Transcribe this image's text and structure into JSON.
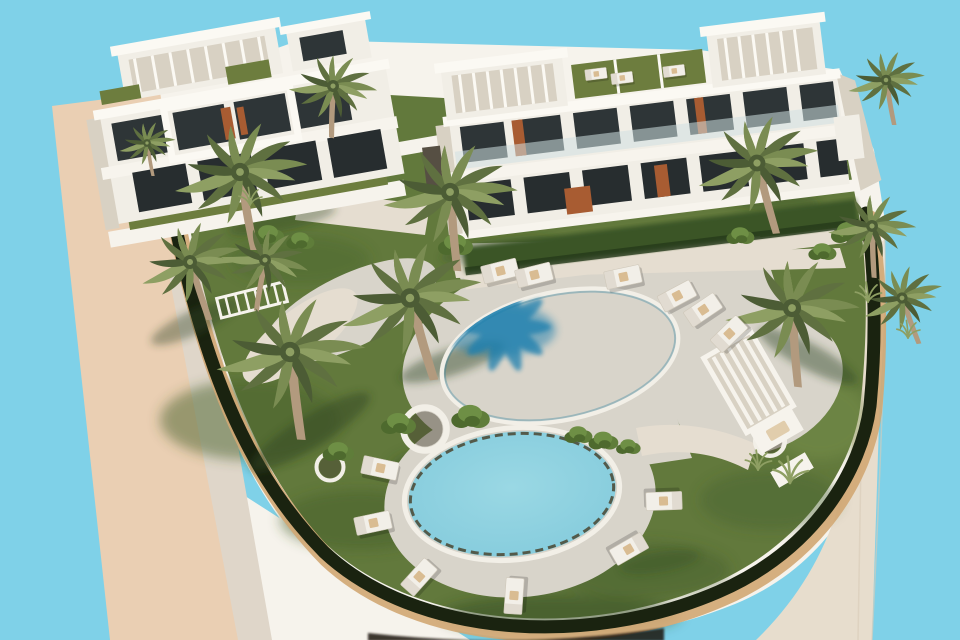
{
  "scene": {
    "type": "3d-architectural-rendering",
    "description": "Aerial 3D rendering of a modern white resort apartment complex: two flat-roofed buildings with pergolas, a large oval swimming pool and a round pool ringed by sun loungers, palm trees, lawns and a curved white boundary wall against a plain light-blue sky background.",
    "palette": {
      "sky": "#7FD1E8",
      "sand": "#EACFB3",
      "sandInner": "#DFD6C9",
      "pavement": "#E7DDCD",
      "seam": "#D9CCB7",
      "wallWhite": "#F6F3EC",
      "hedgeDark": "#1A2310",
      "hedgeTrim": "#D2A773",
      "grass": "#62793C",
      "grassDark": "#46602C",
      "grassLight": "#7D9751",
      "deck": "#D8D4CA",
      "walkwayLight": "#E5DDD0",
      "poolDeep": "#2F98C0",
      "poolMid": "#5FBAD4",
      "poolLight": "#8FD3E1",
      "poolShadow": "#1D7FAE",
      "poolRim": "#2A7D9E",
      "roundPoolLight": "#9AD8E4",
      "roundPoolMid": "#84CBDC",
      "rimDark": "#4A4530",
      "coping": "#F2EFE7",
      "building": "#F1EEE6",
      "buildingShade": "#D8D1C3",
      "slab": "#F7F4ED",
      "slabTop": "#FBF9F3",
      "window": "#2E3537",
      "windowDark": "#272D2F",
      "glassRail": "#CFE0E2",
      "roofTurf": "#6D7D3E",
      "frontHedge": "#3B5526",
      "terracotta": "#A85C32",
      "trunk": "#B29A7E",
      "frond1": "#5F7040",
      "frond2": "#7A8C52",
      "frond3": "#8E9F63",
      "frond4": "#4C5C35",
      "loungerBody": "#F2EFE8",
      "loungerEdge": "#CFC8BA",
      "towel": "#D9BC92",
      "bush1": "#4E6A2E",
      "bush2": "#5F7D3A",
      "bush3": "#6E8F45",
      "shadowGreen": "#2F4520",
      "bottomShadow": "#1F160C"
    },
    "distant_palms": [
      {
        "x": 368,
        "y": 100,
        "s": 0.4,
        "r": 0
      },
      {
        "x": 392,
        "y": 95,
        "s": 0.45,
        "r": 8
      },
      {
        "x": 424,
        "y": 90,
        "s": 0.4,
        "r": -6
      }
    ],
    "palms": [
      {
        "x": 240,
        "y": 172,
        "s": 1.3,
        "r": 0
      },
      {
        "x": 333,
        "y": 86,
        "s": 0.85,
        "r": 12
      },
      {
        "x": 190,
        "y": 262,
        "s": 1.0,
        "r": -8
      },
      {
        "x": 265,
        "y": 260,
        "s": 0.85,
        "r": 20
      },
      {
        "x": 450,
        "y": 192,
        "s": 1.3,
        "r": 5
      },
      {
        "x": 757,
        "y": 163,
        "s": 1.2,
        "r": -5
      },
      {
        "x": 872,
        "y": 226,
        "s": 0.85,
        "r": 8
      },
      {
        "x": 902,
        "y": 298,
        "s": 0.8,
        "r": -10
      },
      {
        "x": 290,
        "y": 352,
        "s": 1.45,
        "r": 3
      },
      {
        "x": 410,
        "y": 298,
        "s": 1.4,
        "r": -6
      },
      {
        "x": 792,
        "y": 308,
        "s": 1.3,
        "r": 6
      },
      {
        "x": 886,
        "y": 80,
        "s": 0.75,
        "r": 0
      },
      {
        "x": 147,
        "y": 143,
        "s": 0.55,
        "r": 0
      }
    ],
    "loungers": [
      {
        "x": 500,
        "y": 271,
        "r": -14,
        "s": 1
      },
      {
        "x": 534,
        "y": 275,
        "r": -14,
        "s": 1
      },
      {
        "x": 623,
        "y": 277,
        "r": -12,
        "s": 1
      },
      {
        "x": 677,
        "y": 296,
        "r": -28,
        "s": 1
      },
      {
        "x": 703,
        "y": 310,
        "r": -34,
        "s": 1
      },
      {
        "x": 729,
        "y": 334,
        "r": -44,
        "s": 1
      },
      {
        "x": 380,
        "y": 468,
        "r": 12,
        "s": 1
      },
      {
        "x": 373,
        "y": 523,
        "r": -12,
        "s": 1
      },
      {
        "x": 419,
        "y": 577,
        "r": -48,
        "s": 1
      },
      {
        "x": 514,
        "y": 596,
        "r": -86,
        "s": 1
      },
      {
        "x": 629,
        "y": 549,
        "r": 150,
        "s": 1
      },
      {
        "x": 664,
        "y": 501,
        "r": 178,
        "s": 1
      },
      {
        "x": 596,
        "y": 74,
        "r": -7,
        "s": 0.6
      },
      {
        "x": 622,
        "y": 78,
        "r": -7,
        "s": 0.6
      },
      {
        "x": 674,
        "y": 71,
        "r": -7,
        "s": 0.6
      }
    ],
    "bushes": [
      {
        "x": 470,
        "y": 417,
        "s": 1.1
      },
      {
        "x": 578,
        "y": 435,
        "s": 0.8
      },
      {
        "x": 603,
        "y": 441,
        "s": 0.85
      },
      {
        "x": 628,
        "y": 447,
        "s": 0.7
      },
      {
        "x": 398,
        "y": 424,
        "s": 1.0
      },
      {
        "x": 268,
        "y": 235,
        "s": 0.9
      },
      {
        "x": 300,
        "y": 241,
        "s": 0.8
      },
      {
        "x": 848,
        "y": 233,
        "s": 1.0
      },
      {
        "x": 822,
        "y": 252,
        "s": 0.8
      },
      {
        "x": 338,
        "y": 452,
        "s": 0.9
      },
      {
        "x": 740,
        "y": 236,
        "s": 0.8
      },
      {
        "x": 455,
        "y": 245,
        "s": 1.0
      }
    ],
    "tufts": [
      {
        "x": 790,
        "y": 483,
        "s": 1.2
      },
      {
        "x": 758,
        "y": 470,
        "s": 0.9
      },
      {
        "x": 868,
        "y": 302,
        "s": 0.9
      },
      {
        "x": 908,
        "y": 338,
        "s": 0.8
      },
      {
        "x": 250,
        "y": 205,
        "s": 0.8
      }
    ],
    "planters": [
      {
        "x": 330,
        "y": 467,
        "s": 1.0
      },
      {
        "x": 425,
        "y": 429,
        "s": 1.6
      },
      {
        "x": 770,
        "y": 441,
        "s": 1.1
      }
    ],
    "tree_shadows": [
      {
        "x": 310,
        "y": 432,
        "rx": 70,
        "ry": 16,
        "r": -32,
        "o": 0.5
      },
      {
        "x": 452,
        "y": 362,
        "rx": 55,
        "ry": 13,
        "r": -18,
        "o": 0.45
      },
      {
        "x": 195,
        "y": 322,
        "rx": 48,
        "ry": 12,
        "r": -25,
        "o": 0.4
      },
      {
        "x": 808,
        "y": 356,
        "rx": 55,
        "ry": 13,
        "r": 28,
        "o": 0.45
      },
      {
        "x": 282,
        "y": 220,
        "rx": 55,
        "ry": 11,
        "r": -12,
        "o": 0.35
      },
      {
        "x": 660,
        "y": 562,
        "rx": 40,
        "ry": 10,
        "r": -10,
        "o": 0.3
      },
      {
        "x": 500,
        "y": 250,
        "rx": 60,
        "ry": 12,
        "r": -8,
        "o": 0.3
      },
      {
        "x": 770,
        "y": 200,
        "rx": 50,
        "ry": 11,
        "r": 5,
        "o": 0.3
      }
    ]
  }
}
